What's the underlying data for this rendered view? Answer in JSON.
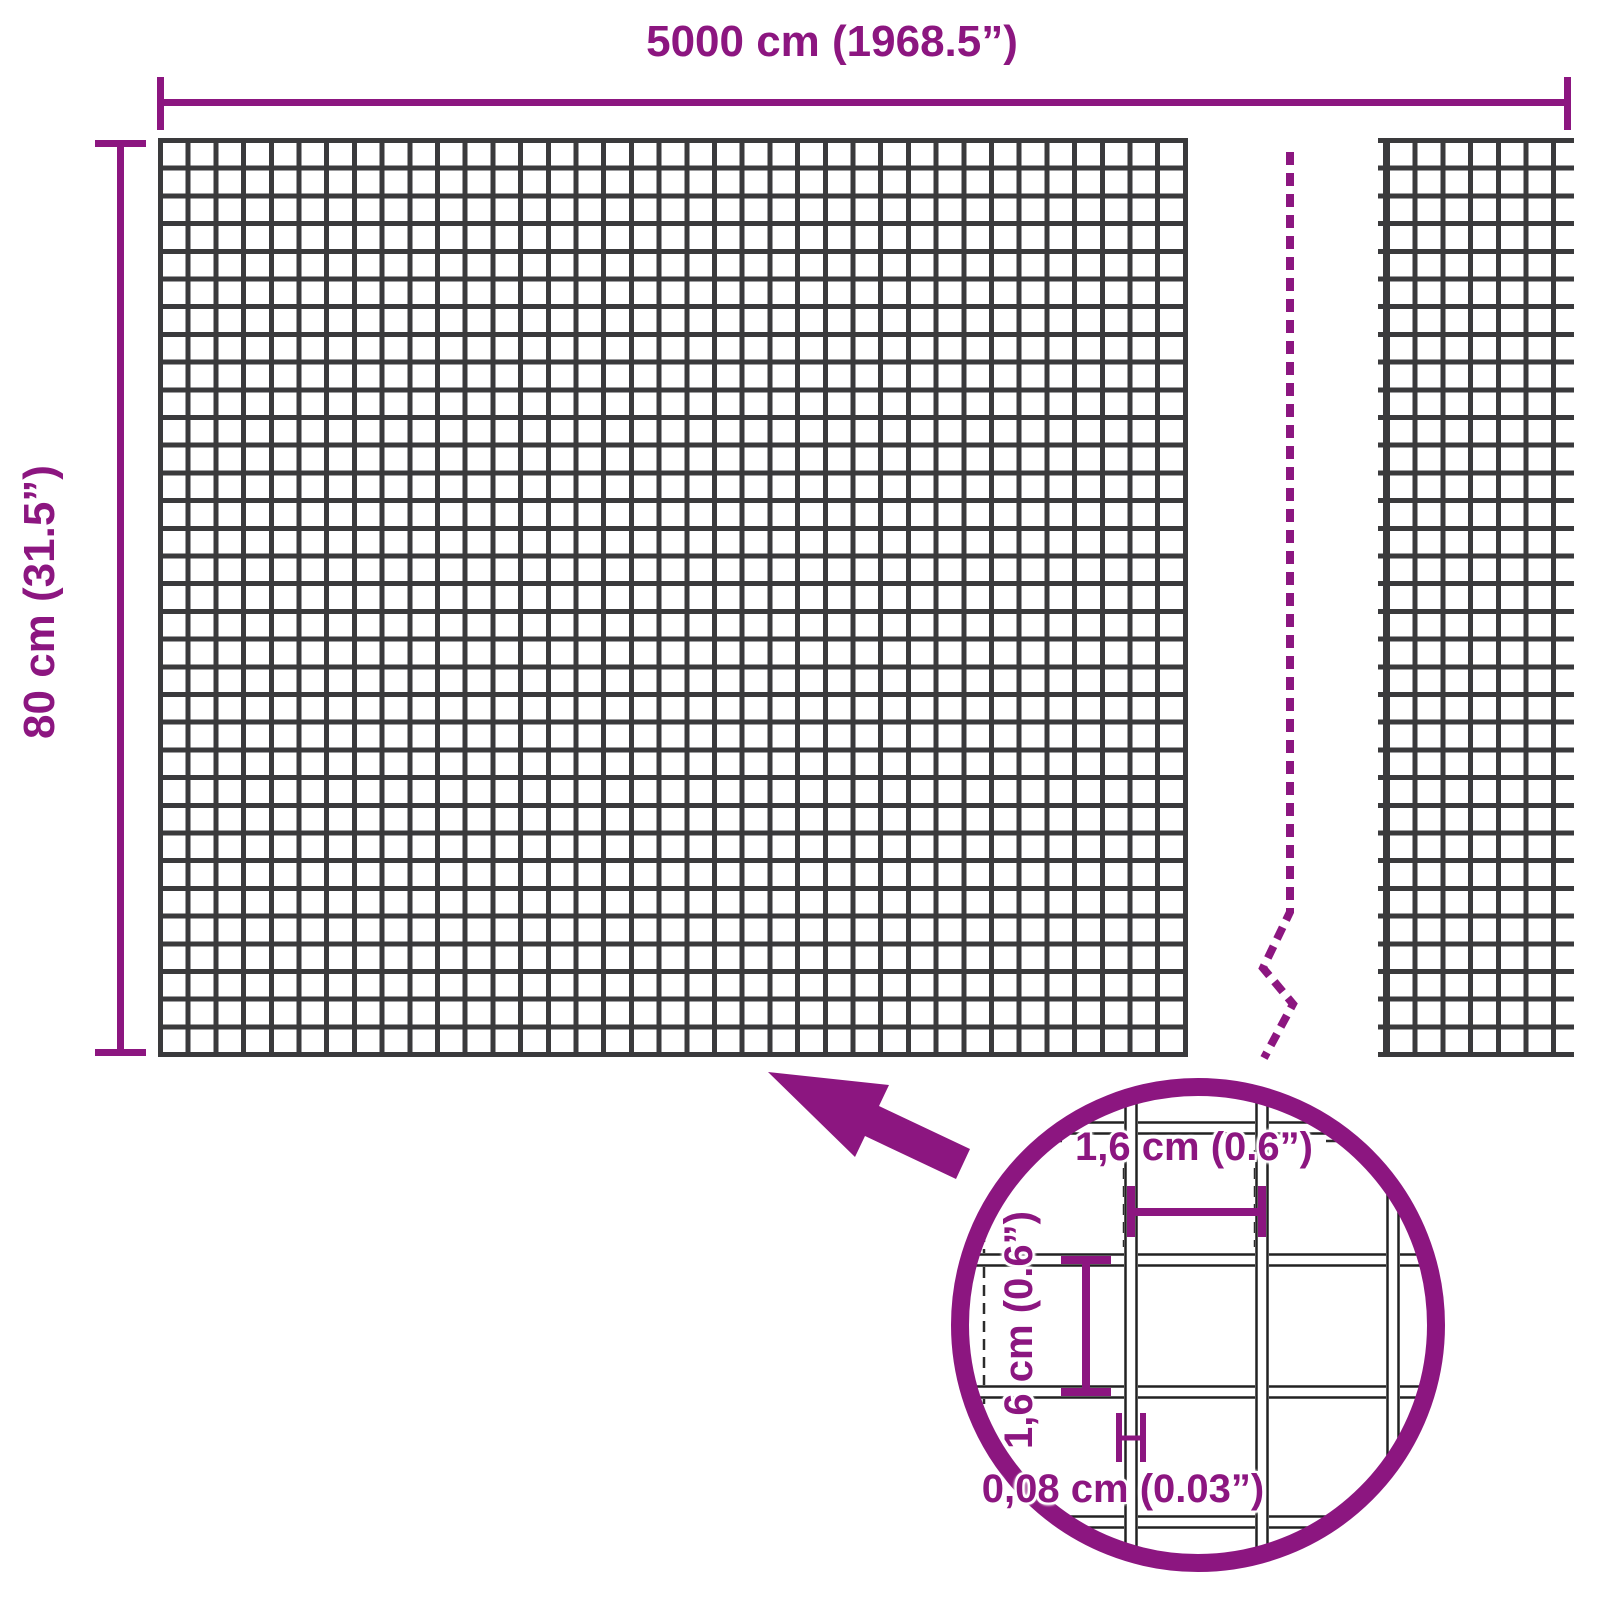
{
  "diagram": {
    "type": "product-dimension-diagram",
    "subject": "welded wire mesh roll"
  },
  "colors": {
    "accent_purple": "#8C1680",
    "mesh_gray": "#3A3A3C",
    "wire_outline": "#222222",
    "background": "#FFFFFF"
  },
  "dimensions": {
    "width_label": "5000 cm (1968.5”)",
    "height_label": "80 cm (31.5”)"
  },
  "magnifier": {
    "mesh_width_label": "1,6 cm (0.6”)",
    "mesh_height_label": "1,6 cm (0.6”)",
    "wire_thickness_label": "0,08 cm (0.03”)"
  }
}
